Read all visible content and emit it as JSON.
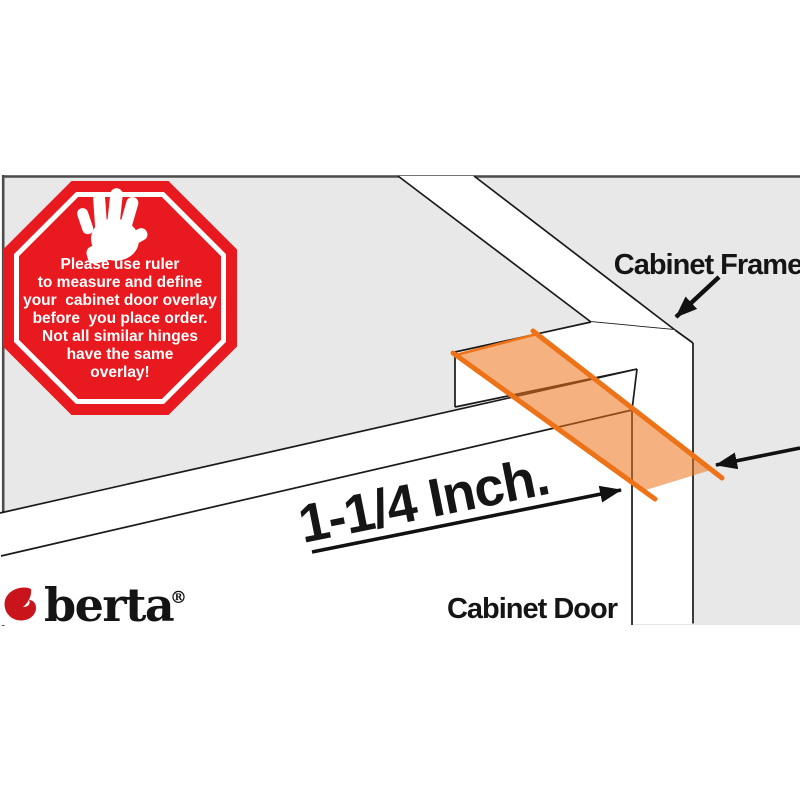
{
  "stop_sign": {
    "lines": [
      "Please use ruler",
      "to measure and define",
      "your  cabinet door overlay",
      "before  you place order.",
      "Not all similar hinges",
      "have the same",
      "overlay!"
    ]
  },
  "labels": {
    "cabinet_frame": "Cabinet Frame",
    "cabinet_door": "Cabinet Door",
    "measurement": "1-1/4 Inch."
  },
  "brand": {
    "name": "berta",
    "registered_mark": "®"
  },
  "colors": {
    "background_gray": "#e8e8e8",
    "line_black": "#1a1a1a",
    "border_gray": "#4c4c4c",
    "overlay_orange": "#ed7218",
    "stop_red": "#e8191f",
    "brand_red": "#c9141c"
  },
  "icons": {
    "stop_hand": "stop-hand-icon",
    "brand_mark": "brand-mark-icon"
  }
}
